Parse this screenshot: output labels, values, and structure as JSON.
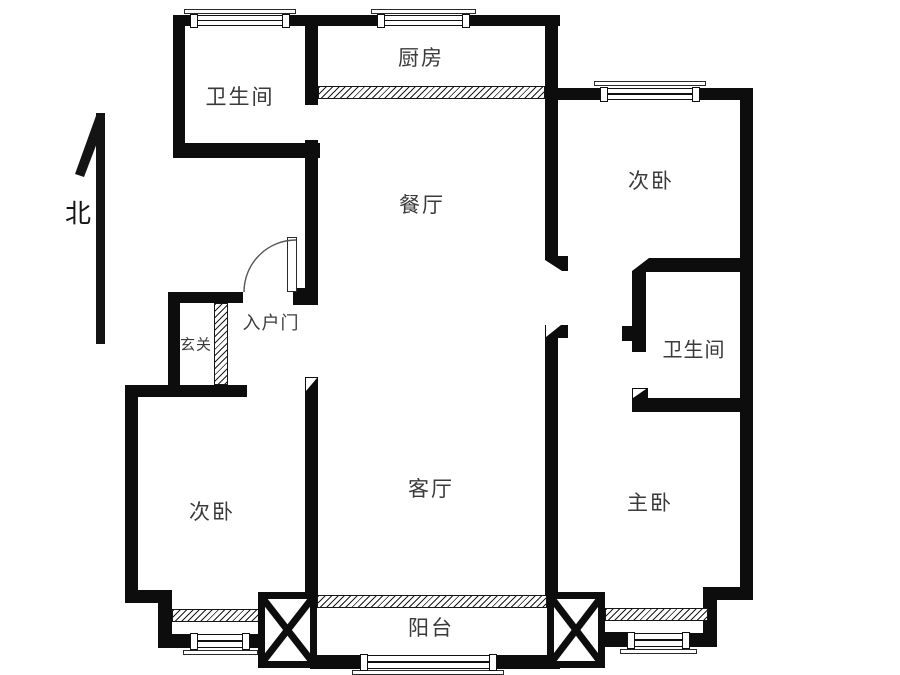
{
  "plan": {
    "type": "apartment-floor-plan",
    "orientation_note": "north arrow at left side"
  },
  "compass": {
    "label": "北"
  },
  "rooms": {
    "bathroom_north": {
      "label": "卫生间"
    },
    "kitchen": {
      "label": "厨房"
    },
    "dining": {
      "label": "餐厅"
    },
    "bedroom_ne": {
      "label": "次卧"
    },
    "bathroom_east": {
      "label": "卫生间"
    },
    "entry_door": {
      "label": "入户门"
    },
    "foyer": {
      "label": "玄关"
    },
    "bedroom_sw": {
      "label": "次卧"
    },
    "living": {
      "label": "客厅"
    },
    "master_bedroom": {
      "label": "主卧"
    },
    "balcony": {
      "label": "阳台"
    }
  },
  "colors": {
    "wall": "#0d0d0d",
    "label": "#3a3a3a",
    "background": "#ffffff"
  }
}
